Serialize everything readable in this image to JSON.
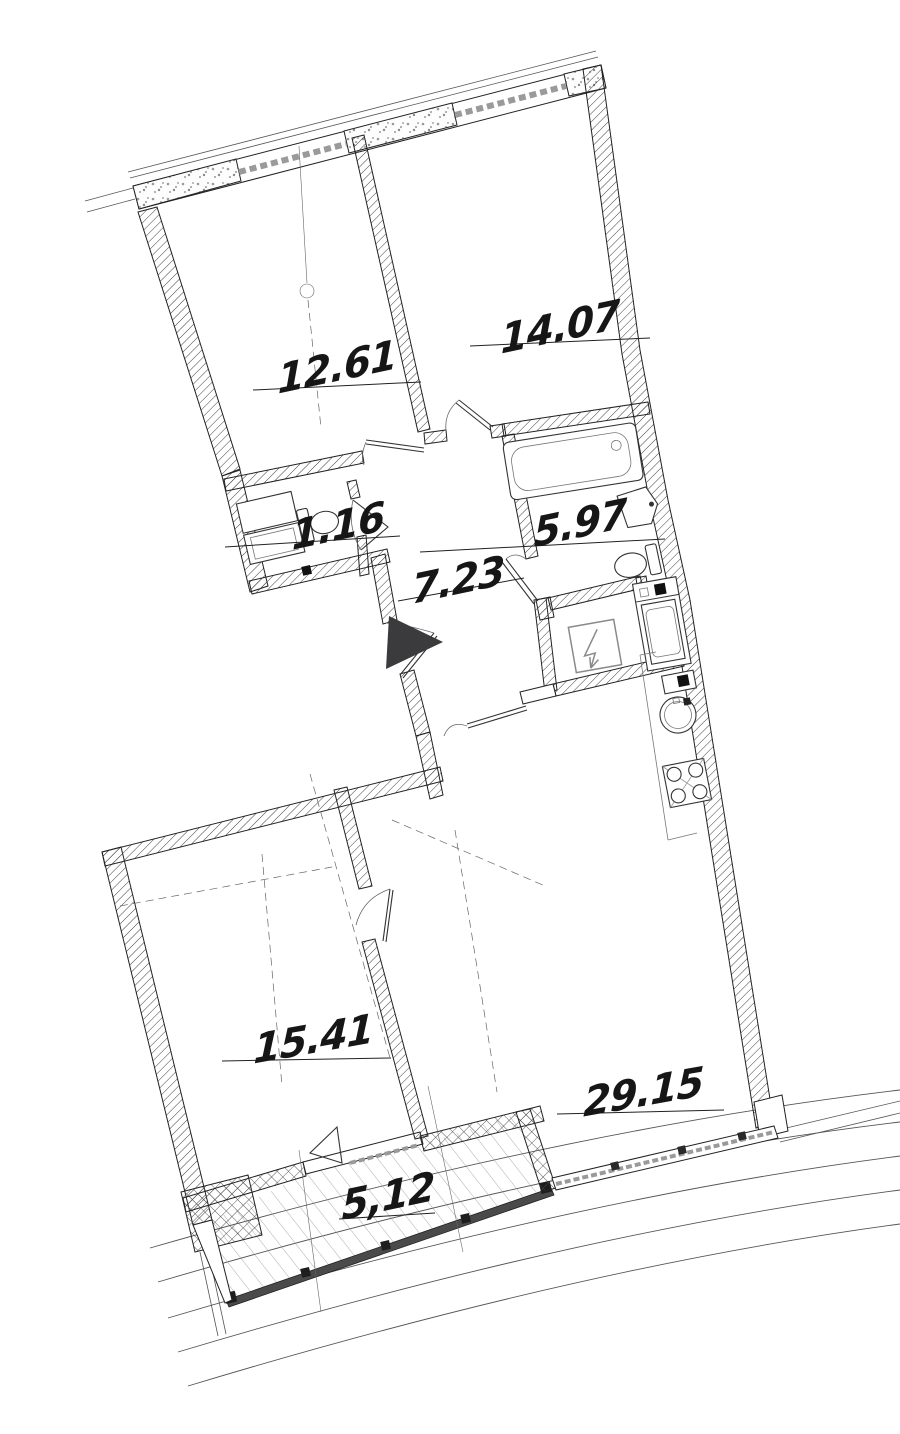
{
  "drawing": {
    "type": "apartment-floor-plan",
    "rooms": [
      {
        "name": "bedroom-1",
        "label": "12.61"
      },
      {
        "name": "bedroom-2",
        "label": "14.07"
      },
      {
        "name": "wc",
        "label": "1.16"
      },
      {
        "name": "hallway",
        "label": "7.23"
      },
      {
        "name": "bathroom",
        "label": "5.97"
      },
      {
        "name": "room",
        "label": "15.41"
      },
      {
        "name": "kitchen-living",
        "label": "29.15"
      },
      {
        "name": "balcony",
        "label": "5,12"
      }
    ],
    "colors": {
      "ink": "#161616",
      "wall_hatch": "#3a3a3a",
      "glass_band": "#9a9a9a",
      "glazing_dark": "#4a4a4a",
      "entrance_arrow": "#3b3b3e",
      "light_line": "#777777"
    },
    "symbols": [
      "entrance-arrow",
      "bathtub",
      "washbasin",
      "toilet",
      "cabinet",
      "washing-machine",
      "electric-meter",
      "electrical-panel",
      "kitchen-sink",
      "stove",
      "door-swing",
      "window-band",
      "balcony-glazing",
      "balcony-hatch",
      "facade-arcs"
    ]
  }
}
